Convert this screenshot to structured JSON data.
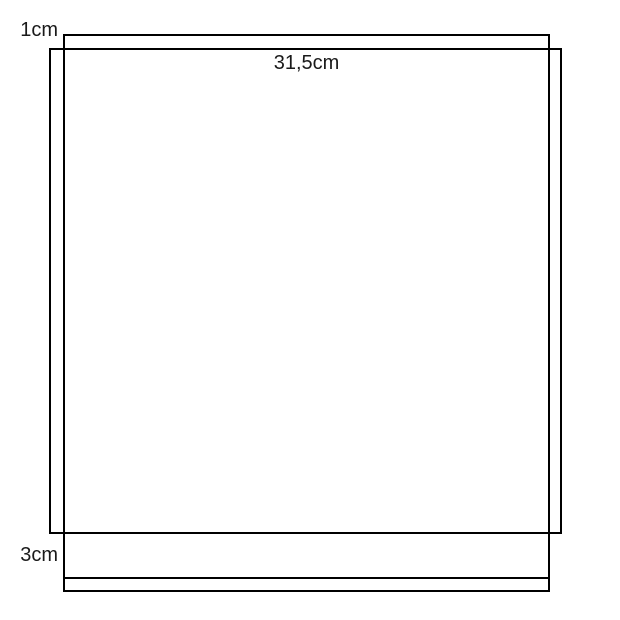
{
  "diagram": {
    "type": "measurement-pattern-drawing",
    "colors": {
      "background": "#ffffff",
      "line": "#000000",
      "text": "#1a1a1a"
    },
    "labels": {
      "top_allowance": "1cm",
      "width": "31,5cm",
      "bottom_hem": "3cm"
    }
  }
}
